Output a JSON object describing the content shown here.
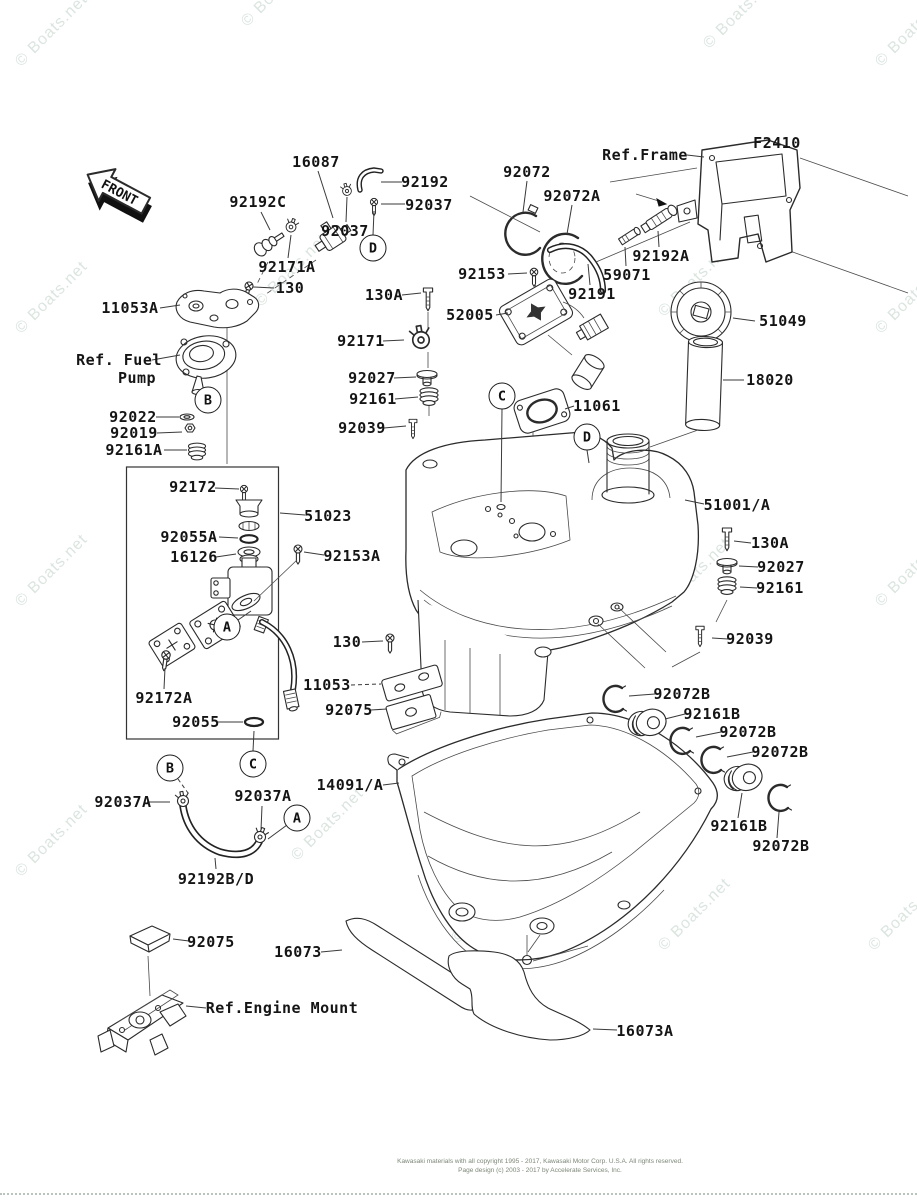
{
  "front_arrow": {
    "label": "FRONT"
  },
  "watermark": {
    "text": "© Boats.net"
  },
  "footer": {
    "line1": "Kawasaki materials with all copyright 1995 - 2017, Kawasaki Motor Corp. U.S.A. All rights reserved.",
    "line2": "Page design (c) 2003 - 2017 by Accelerate Services, Inc."
  },
  "part_labels": [
    {
      "text": "16087",
      "x": 316,
      "y": 162,
      "line": [
        318,
        171,
        333,
        218
      ]
    },
    {
      "text": "92192",
      "x": 425,
      "y": 182,
      "line": [
        402,
        182,
        381,
        182
      ]
    },
    {
      "text": "92037",
      "x": 429,
      "y": 205,
      "line": [
        405,
        204,
        381,
        204
      ]
    },
    {
      "text": "92192C",
      "x": 258,
      "y": 202,
      "line": [
        261,
        212,
        270,
        230
      ]
    },
    {
      "text": "92037",
      "x": 345,
      "y": 231,
      "line": [
        346,
        222,
        347,
        197
      ]
    },
    {
      "text": "92171A",
      "x": 287,
      "y": 267,
      "line": [
        288,
        258,
        291,
        235
      ]
    },
    {
      "text": "130",
      "x": 290,
      "y": 288,
      "line": [
        274,
        288,
        253,
        287
      ]
    },
    {
      "text": "92072",
      "x": 527,
      "y": 172,
      "line": [
        527,
        181,
        523,
        212
      ]
    },
    {
      "text": "92072A",
      "x": 572,
      "y": 196,
      "line": [
        572,
        205,
        567,
        234
      ]
    },
    {
      "text": "Ref.Frame",
      "x": 645,
      "y": 155,
      "line": [
        687,
        155,
        704,
        157
      ]
    },
    {
      "text": "F2410",
      "x": 777,
      "y": 143
    },
    {
      "text": "92192A",
      "x": 661,
      "y": 256,
      "line": [
        659,
        247,
        658,
        231
      ]
    },
    {
      "text": "59071",
      "x": 627,
      "y": 275,
      "line": [
        626,
        266,
        625,
        247
      ]
    },
    {
      "text": "92153",
      "x": 482,
      "y": 274,
      "line": [
        508,
        274,
        527,
        273
      ]
    },
    {
      "text": "92191",
      "x": 592,
      "y": 294,
      "line": [
        590,
        285,
        588,
        264
      ]
    },
    {
      "text": "52005",
      "x": 470,
      "y": 315,
      "line": [
        496,
        315,
        508,
        313
      ]
    },
    {
      "text": "51049",
      "x": 783,
      "y": 321,
      "line": [
        755,
        321,
        733,
        318
      ]
    },
    {
      "text": "18020",
      "x": 770,
      "y": 380,
      "line": [
        744,
        380,
        723,
        380
      ]
    },
    {
      "text": "11061",
      "x": 597,
      "y": 406,
      "line": [
        574,
        406,
        565,
        409
      ]
    },
    {
      "text": "11053A",
      "x": 130,
      "y": 308,
      "line": [
        160,
        308,
        180,
        305
      ]
    },
    {
      "text": "Ref. Fuel",
      "x": 119,
      "y": 360,
      "line": [
        152,
        360,
        180,
        355
      ]
    },
    {
      "text": "Pump",
      "x": 137,
      "y": 378
    },
    {
      "text": "92022",
      "x": 133,
      "y": 417,
      "line": [
        156,
        417,
        179,
        417
      ]
    },
    {
      "text": "92019",
      "x": 134,
      "y": 433,
      "line": [
        157,
        433,
        182,
        432
      ]
    },
    {
      "text": "92161A",
      "x": 134,
      "y": 450,
      "line": [
        164,
        450,
        187,
        450
      ]
    },
    {
      "text": "130A",
      "x": 384,
      "y": 295,
      "line": [
        402,
        295,
        421,
        293
      ]
    },
    {
      "text": "92171",
      "x": 361,
      "y": 341,
      "line": [
        383,
        341,
        404,
        340
      ]
    },
    {
      "text": "92027",
      "x": 372,
      "y": 378,
      "line": [
        394,
        378,
        416,
        377
      ]
    },
    {
      "text": "92161",
      "x": 373,
      "y": 399,
      "line": [
        395,
        399,
        418,
        397
      ]
    },
    {
      "text": "92039",
      "x": 362,
      "y": 428,
      "line": [
        384,
        428,
        406,
        426
      ]
    },
    {
      "text": "92172",
      "x": 193,
      "y": 487,
      "line": [
        215,
        488,
        239,
        489
      ]
    },
    {
      "text": "51023",
      "x": 328,
      "y": 516,
      "line": [
        305,
        515,
        280,
        513
      ]
    },
    {
      "text": "92055A",
      "x": 189,
      "y": 537,
      "line": [
        219,
        537,
        238,
        538
      ]
    },
    {
      "text": "16126",
      "x": 194,
      "y": 557,
      "line": [
        216,
        557,
        236,
        554
      ]
    },
    {
      "text": "92153A",
      "x": 352,
      "y": 556,
      "line": [
        324,
        555,
        304,
        552
      ]
    },
    {
      "text": "51001/A",
      "x": 737,
      "y": 505,
      "line": [
        704,
        504,
        685,
        500
      ]
    },
    {
      "text": "130A",
      "x": 770,
      "y": 543,
      "line": [
        751,
        543,
        734,
        541
      ]
    },
    {
      "text": "92027",
      "x": 781,
      "y": 567,
      "line": [
        758,
        567,
        739,
        566
      ]
    },
    {
      "text": "92161",
      "x": 780,
      "y": 588,
      "line": [
        757,
        588,
        740,
        587
      ]
    },
    {
      "text": "92039",
      "x": 750,
      "y": 639,
      "line": [
        728,
        639,
        712,
        638
      ]
    },
    {
      "text": "130",
      "x": 347,
      "y": 642,
      "line": [
        362,
        642,
        383,
        641
      ]
    },
    {
      "text": "11053",
      "x": 327,
      "y": 685,
      "line": [
        351,
        685,
        381,
        684
      ],
      "dash": true
    },
    {
      "text": "92075",
      "x": 349,
      "y": 710,
      "line": [
        371,
        710,
        387,
        709
      ]
    },
    {
      "text": "14091/A",
      "x": 350,
      "y": 785,
      "line": [
        383,
        785,
        399,
        783
      ]
    },
    {
      "text": "92072B",
      "x": 682,
      "y": 694,
      "line": [
        655,
        694,
        629,
        696
      ]
    },
    {
      "text": "92161B",
      "x": 712,
      "y": 714,
      "line": [
        685,
        714,
        665,
        719
      ]
    },
    {
      "text": "92072B",
      "x": 748,
      "y": 732,
      "line": [
        721,
        732,
        696,
        737
      ]
    },
    {
      "text": "92072B",
      "x": 780,
      "y": 752,
      "line": [
        753,
        752,
        727,
        757
      ]
    },
    {
      "text": "92161B",
      "x": 739,
      "y": 826,
      "line": [
        738,
        818,
        742,
        793
      ]
    },
    {
      "text": "92072B",
      "x": 781,
      "y": 846,
      "line": [
        777,
        838,
        779,
        812
      ]
    },
    {
      "text": "92172A",
      "x": 164,
      "y": 698,
      "line": [
        164,
        689,
        165,
        668
      ]
    },
    {
      "text": "92055",
      "x": 196,
      "y": 722,
      "line": [
        218,
        722,
        243,
        722
      ]
    },
    {
      "text": "92037A",
      "x": 123,
      "y": 802,
      "line": [
        147,
        802,
        170,
        802
      ]
    },
    {
      "text": "92037A",
      "x": 263,
      "y": 796,
      "line": [
        262,
        806,
        261,
        830
      ]
    },
    {
      "text": "92192B/D",
      "x": 216,
      "y": 879,
      "line": [
        216,
        869,
        215,
        858
      ]
    },
    {
      "text": "92075",
      "x": 211,
      "y": 942,
      "line": [
        189,
        941,
        173,
        939
      ]
    },
    {
      "text": "16073",
      "x": 298,
      "y": 952,
      "line": [
        321,
        952,
        342,
        950
      ]
    },
    {
      "text": "Ref.Engine Mount",
      "x": 282,
      "y": 1008,
      "line": [
        206,
        1008,
        186,
        1006
      ]
    },
    {
      "text": "16073A",
      "x": 645,
      "y": 1031,
      "line": [
        617,
        1030,
        593,
        1029
      ]
    }
  ],
  "callouts": [
    {
      "letter": "D",
      "x": 373,
      "y": 248,
      "line": [
        374,
        211,
        373,
        235
      ]
    },
    {
      "letter": "B",
      "x": 208,
      "y": 400
    },
    {
      "letter": "C",
      "x": 502,
      "y": 396,
      "line": [
        502,
        409,
        501,
        502
      ]
    },
    {
      "letter": "D",
      "x": 587,
      "y": 437,
      "line": [
        587,
        450,
        589,
        463
      ]
    },
    {
      "letter": "A",
      "x": 227,
      "y": 627,
      "line": [
        238,
        620,
        251,
        611
      ]
    },
    {
      "letter": "B",
      "x": 170,
      "y": 768,
      "line": [
        178,
        779,
        188,
        793
      ],
      "dash": true
    },
    {
      "letter": "C",
      "x": 253,
      "y": 764,
      "line": [
        253,
        751,
        254,
        731
      ]
    },
    {
      "letter": "A",
      "x": 297,
      "y": 818,
      "line": [
        287,
        825,
        268,
        839
      ]
    }
  ]
}
